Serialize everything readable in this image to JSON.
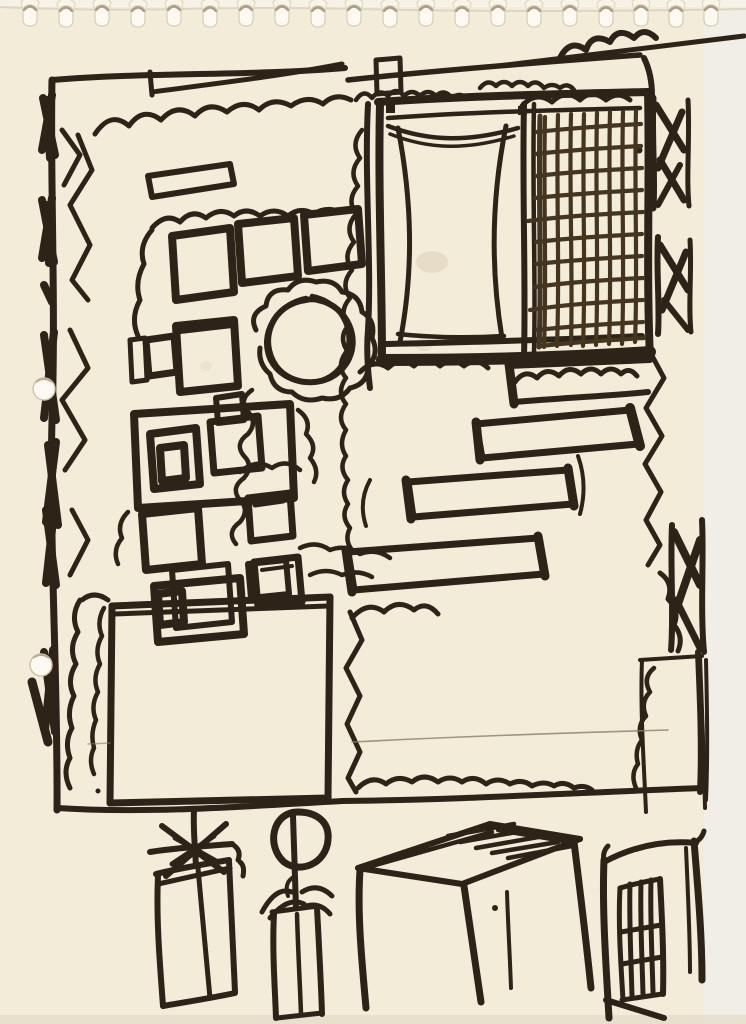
{
  "scene": {
    "type": "hand-drawn-sketch",
    "subject": "felt-tip marker garden plan on spiral notebook paper",
    "description": "Black marker plan-view sketch of a garden: hedged scalloped borders, a gridded pavilion with trellis panel at top right, rows of square planters, a round tree with scalloped canopy, three staggered rectangular raised beds, two large open lawn squares, and below the plan four elevation doodles - a spiky plant in a tall box planter, a standard lollipop tree in a pot, a pergola table, and a garden gate.",
    "text_content": "none - the drawing contains no written text"
  },
  "colors": {
    "paper": "#f3ecd9",
    "ink": "#2d2318",
    "ink_light": "#44351f",
    "pencil": "#8a7e6a",
    "scan_background": "#f0eee7",
    "hole_fill": "#fbf9f1",
    "shadow": "#c6bca6"
  },
  "paper": {
    "spiral_hole_count": 20,
    "punch_hole_count": 2
  }
}
